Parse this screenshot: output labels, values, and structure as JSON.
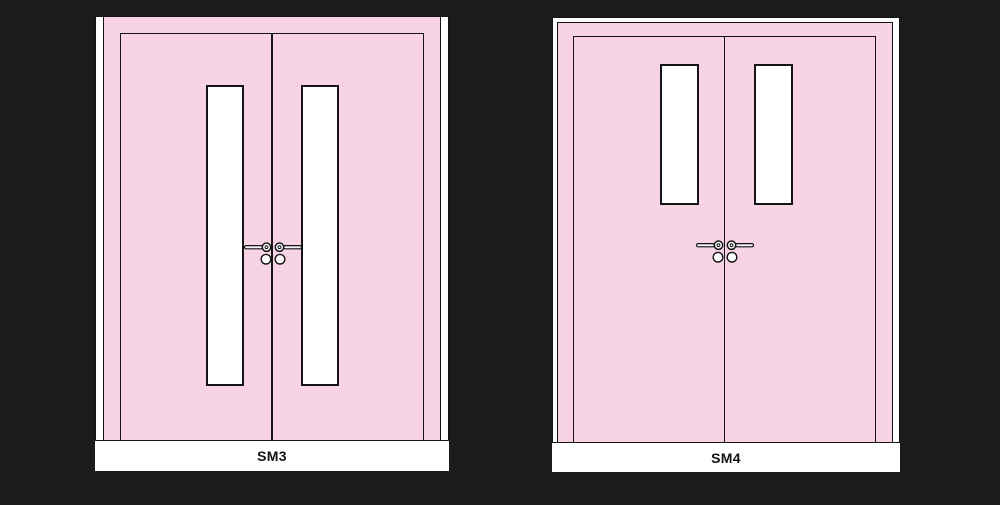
{
  "colors": {
    "background": "#1b1b1b",
    "door": "#f8d3e5",
    "outline": "#151515",
    "panel": "#ffffff",
    "band": "#ffffff",
    "label_text": "#111111",
    "hardware_fill": "#f4f4f4"
  },
  "figures": [
    {
      "label": "SM3",
      "hardware_icons": [
        "lever-handle-icon",
        "door-knob-icon"
      ]
    },
    {
      "label": "SM4",
      "hardware_icons": [
        "lever-handle-icon",
        "door-knob-icon"
      ]
    }
  ]
}
